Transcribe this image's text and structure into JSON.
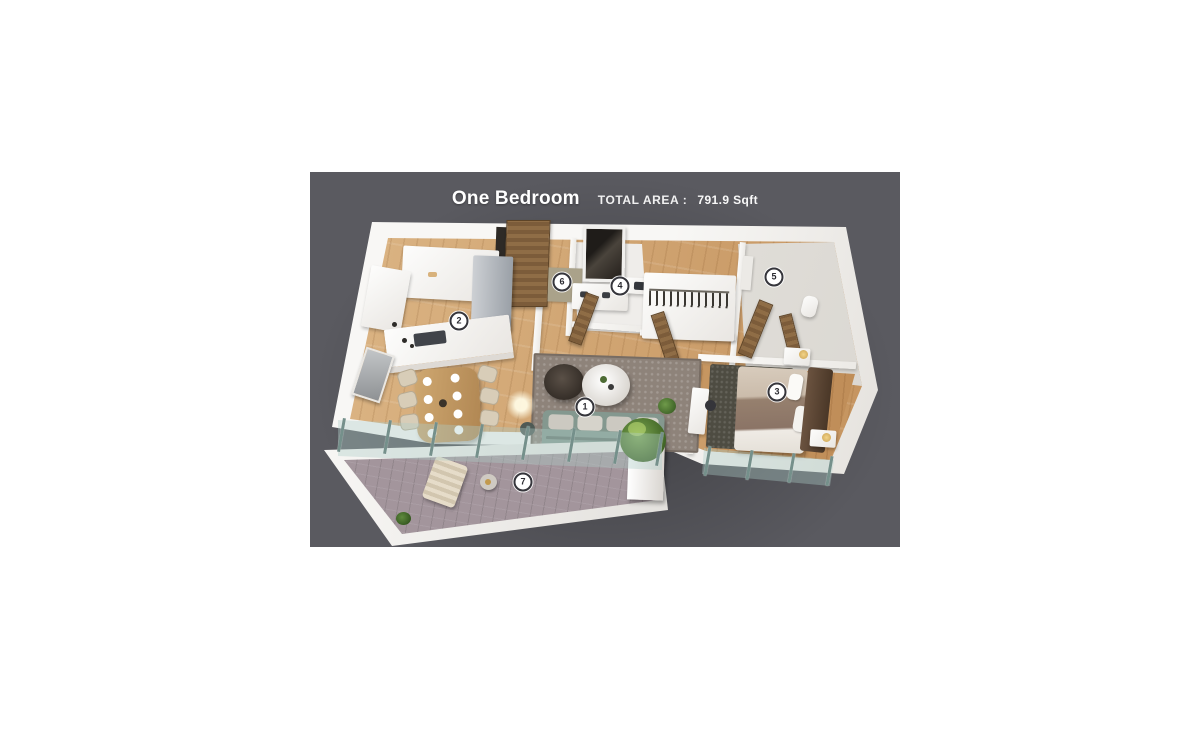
{
  "header": {
    "title": "One Bedroom",
    "area_label": "TOTAL AREA :",
    "area_value": "791.9 Sqft"
  },
  "colors": {
    "page_bg": "#ffffff",
    "panel_bg": "#5a5a60",
    "wall": "#f4f3f0",
    "wood_light": "#ddb787",
    "wood_dark": "#c3915c",
    "door_wood": "#81603c",
    "glass": "#b9d2cf",
    "rug_living": "#8e837a",
    "rug_bedroom": "#4e4c42",
    "sofa": "#84988f",
    "balcony_floor": "#a3959c",
    "marker_bg": "#ffffff",
    "marker_border": "#35353b",
    "marker_text": "#2a2a30"
  },
  "floorplan": {
    "markers": [
      {
        "num": "1",
        "room": "living-room",
        "x": 275,
        "y": 235
      },
      {
        "num": "2",
        "room": "kitchen",
        "x": 149,
        "y": 149
      },
      {
        "num": "3",
        "room": "bedroom",
        "x": 467,
        "y": 220
      },
      {
        "num": "4",
        "room": "bathroom",
        "x": 310,
        "y": 114
      },
      {
        "num": "5",
        "room": "closet-room",
        "x": 464,
        "y": 105
      },
      {
        "num": "6",
        "room": "entry",
        "x": 252,
        "y": 110
      },
      {
        "num": "7",
        "room": "balcony",
        "x": 213,
        "y": 310
      }
    ]
  }
}
